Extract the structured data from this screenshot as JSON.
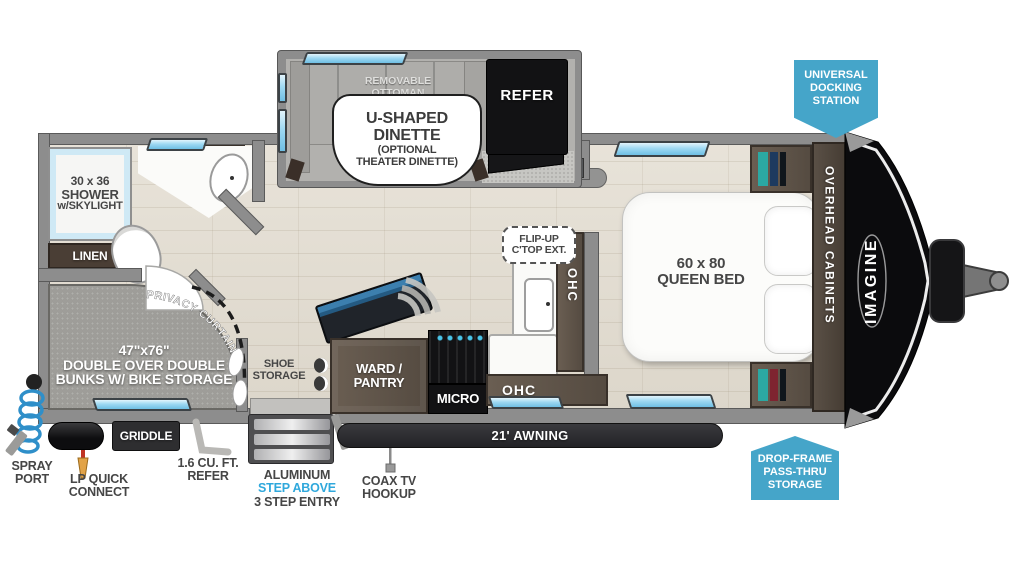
{
  "colors": {
    "badge_blue": "#45a5c9",
    "step_blue": "#2fa8dc",
    "window_blue": "#9fd9f2"
  },
  "badges": {
    "docking": [
      "UNIVERSAL",
      "DOCKING",
      "STATION"
    ],
    "passthru": [
      "DROP-FRAME",
      "PASS-THRU",
      "STORAGE"
    ]
  },
  "bathroom": {
    "shower": [
      "30 x 36",
      "SHOWER",
      "w/SKYLIGHT"
    ],
    "linen": "LINEN"
  },
  "bunkroom": {
    "privacy": "PRIVACY CURTAINS",
    "bunks": [
      "47\"x76\"",
      "DOUBLE OVER DOUBLE",
      "BUNKS W/ BIKE STORAGE"
    ]
  },
  "dinette": {
    "ottoman": [
      "REMOVABLE",
      "OTTOMAN"
    ],
    "label": [
      "U-SHAPED",
      "DINETTE",
      "(OPTIONAL",
      "THEATER DINETTE)"
    ],
    "refer": "REFER"
  },
  "kitchen": {
    "ward": [
      "WARD /",
      "PANTRY"
    ],
    "micro": "MICRO",
    "ohc_side": "OHC",
    "ohc_bottom": "OHC",
    "flip": [
      "FLIP-UP",
      "C'TOP EXT."
    ]
  },
  "bedroom": {
    "bed": [
      "60 x 80",
      "QUEEN BED"
    ],
    "cabinets": "OVERHEAD CABINETS",
    "brand": "IMAGINE"
  },
  "entry": {
    "shoe": [
      "SHOE",
      "STORAGE"
    ],
    "steps": [
      "ALUMINUM",
      "STEP ABOVE",
      "3 STEP ENTRY"
    ]
  },
  "exterior": {
    "awning": "21' AWNING",
    "griddle": "GRIDDLE",
    "spray": [
      "SPRAY",
      "PORT"
    ],
    "lp": [
      "LP QUICK",
      "CONNECT"
    ],
    "refer_small": [
      "1.6 CU. FT.",
      "REFER"
    ],
    "coax": [
      "COAX TV",
      "HOOKUP"
    ]
  }
}
